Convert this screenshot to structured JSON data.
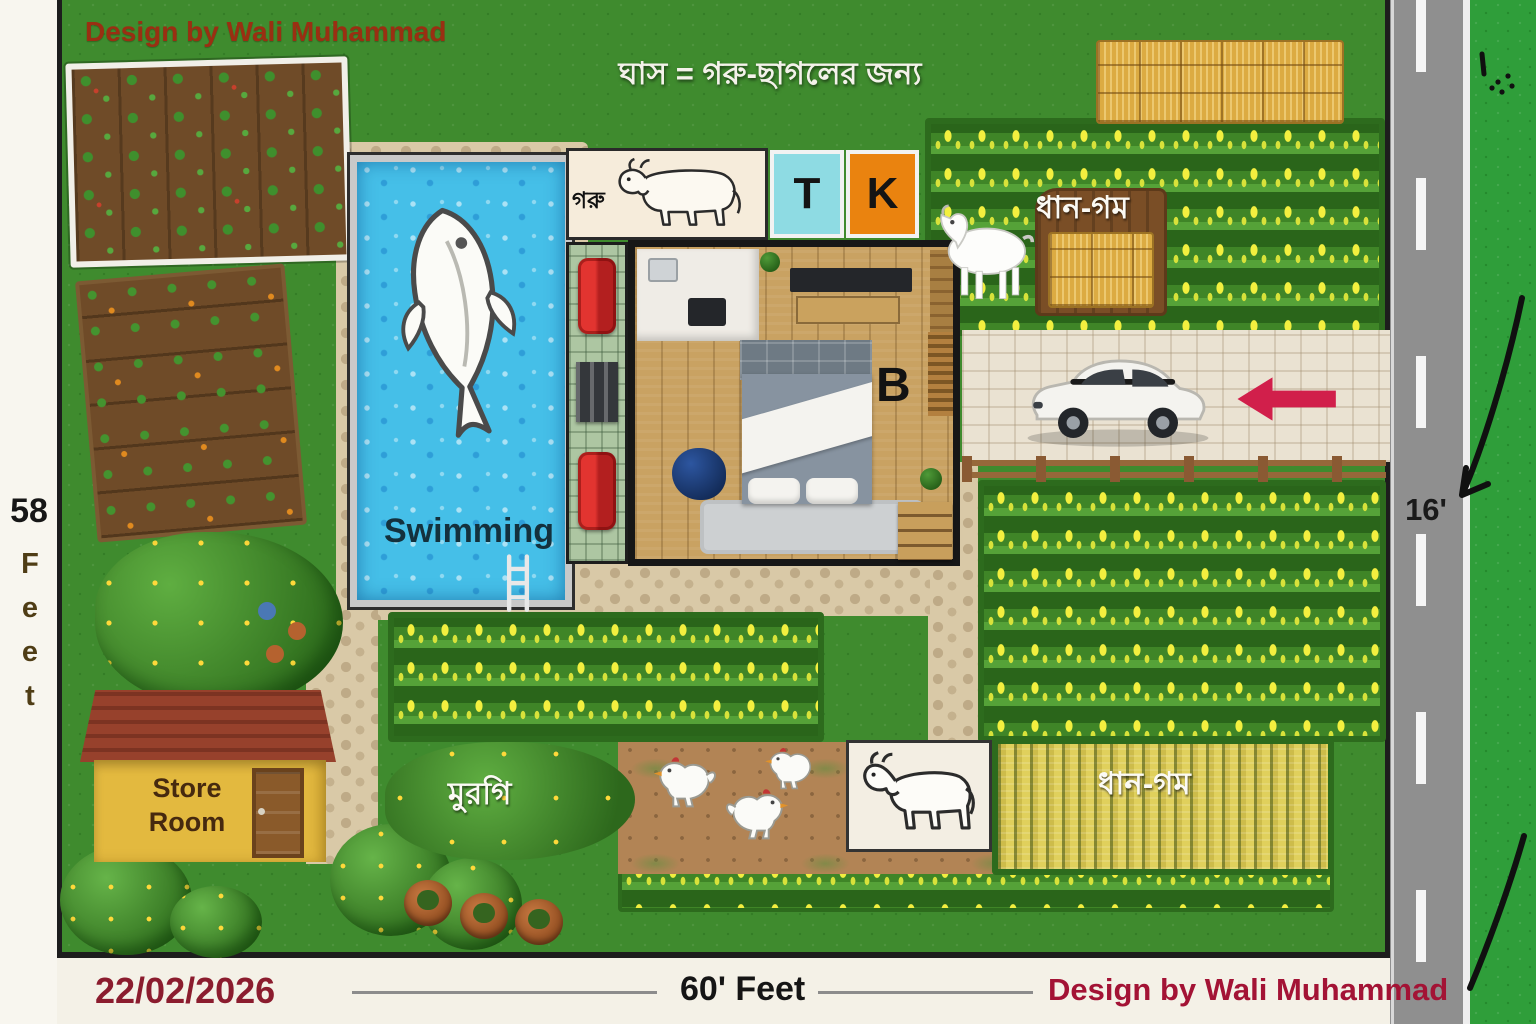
{
  "frame": {
    "left_dim_value": "58",
    "left_dim_unit": "Feet",
    "road_width_label": "16'",
    "date_label": "22/02/2026",
    "bottom_dim_label": "60' Feet",
    "credit_bottom": "Design by Wali Muhammad"
  },
  "plot": {
    "credit_top": "Design by Wali Muhammad",
    "grass_note_bn": "ঘাস = গরু-ছাগলের জন্য",
    "cow_pen": {
      "label_bn": "গরু"
    },
    "rooms": {
      "toilet": "T",
      "kitchen": "K",
      "bedroom": "B"
    },
    "pool": {
      "label": "Swimming"
    },
    "fields": {
      "paddy_wheat_top_bn": "ধান-গম",
      "paddy_wheat_bottom_bn": "ধান-গম"
    },
    "store_room": {
      "label": "Store Room"
    },
    "chicken_area": {
      "label_bn": "মুরগি"
    }
  },
  "colors": {
    "grass": "#3f8b2e",
    "road": "#8f8f8f",
    "pool_water": "#45bfe8",
    "t_box_cyan": "#8edbe3",
    "k_box_orange": "#ea830f",
    "store_wall_yellow": "#e3b93f",
    "store_roof_red": "#97412c",
    "arrow_red": "#d11f4b",
    "credit_top_red": "#9a2f12",
    "credit_bottom_red": "#a31335",
    "date_red": "#8b1c2e"
  }
}
